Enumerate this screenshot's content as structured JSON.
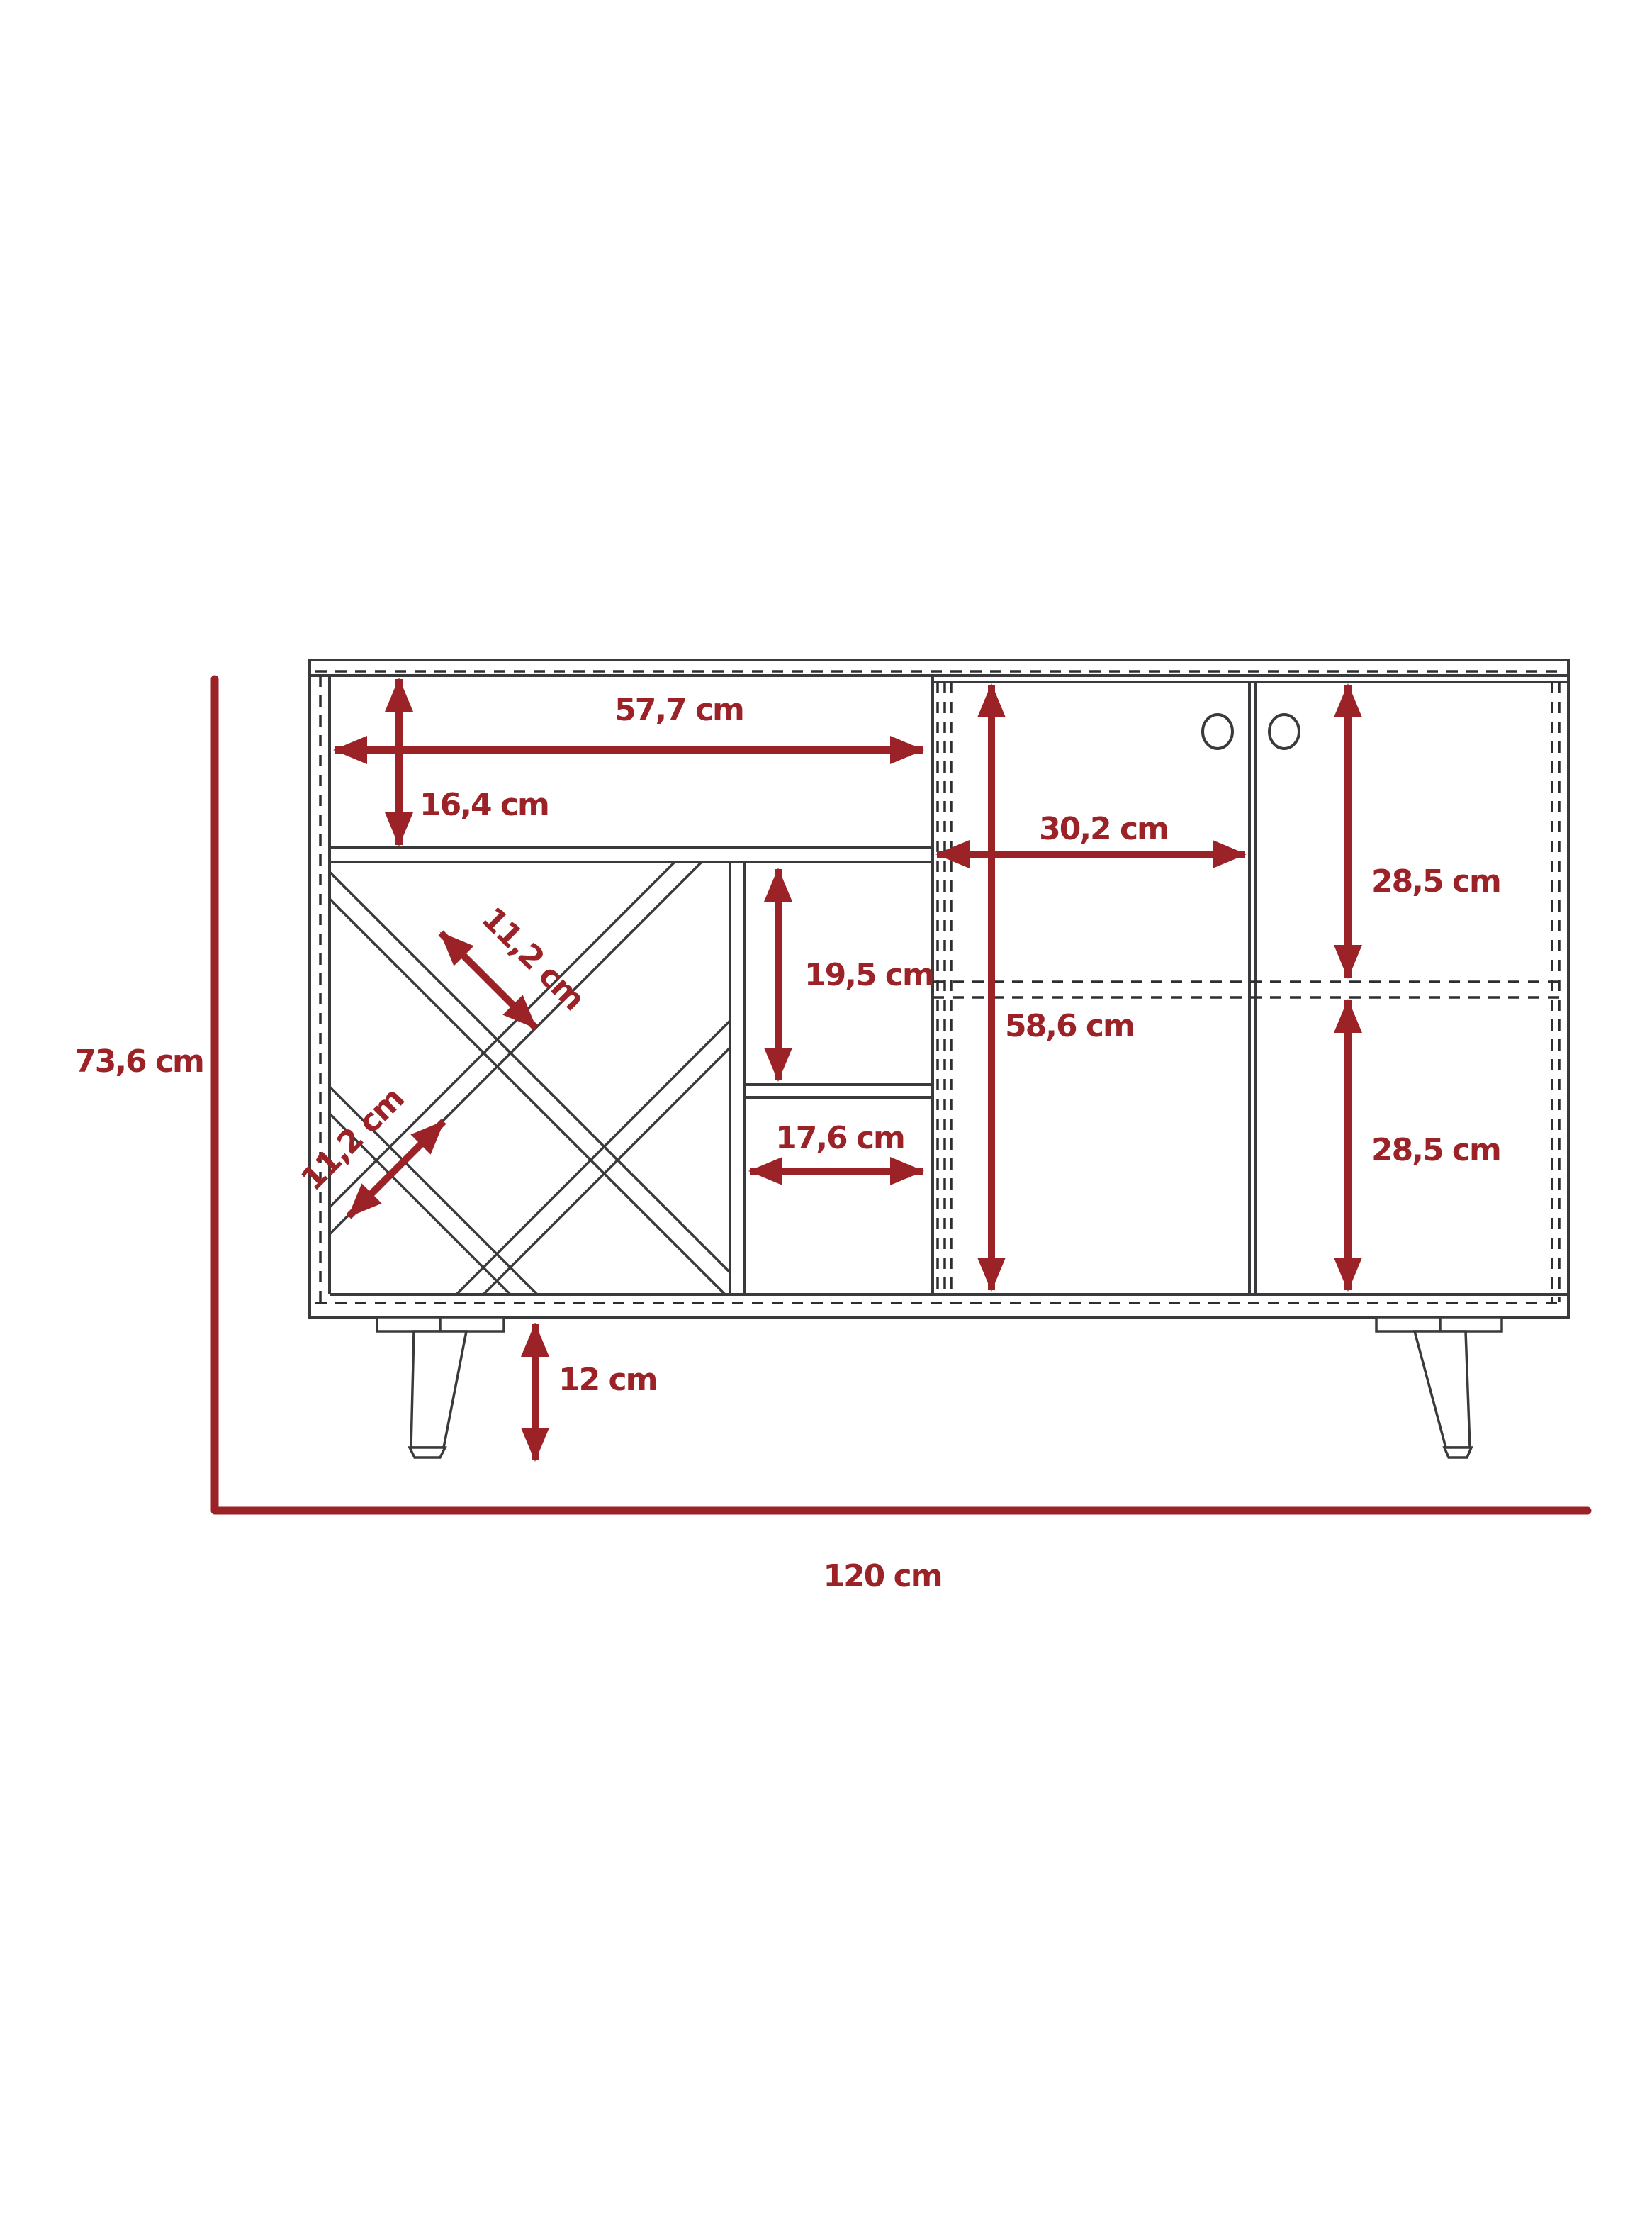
{
  "diagram": {
    "type": "furniture-dimension-drawing",
    "object": "bar-cabinet-sideboard-with-wine-rack",
    "unit": "cm",
    "colors": {
      "dimension_red": "#9b2328",
      "outline_gray": "#3a3a3c",
      "background": "#ffffff"
    },
    "labels": {
      "overall_height": "73,6 cm",
      "overall_width": "120 cm",
      "top_shelf_width": "57,7 cm",
      "top_shelf_height": "16,4 cm",
      "wine_slot_upper": "11,2 cm",
      "wine_slot_lower": "11,2 cm",
      "middle_upper_height": "19,5 cm",
      "middle_lower_width": "17,6 cm",
      "door_width": "30,2 cm",
      "door_upper_height": "28,5 cm",
      "cabinet_inner_height": "58,6 cm",
      "door_lower_height": "28,5 cm",
      "leg_height": "12 cm"
    }
  }
}
